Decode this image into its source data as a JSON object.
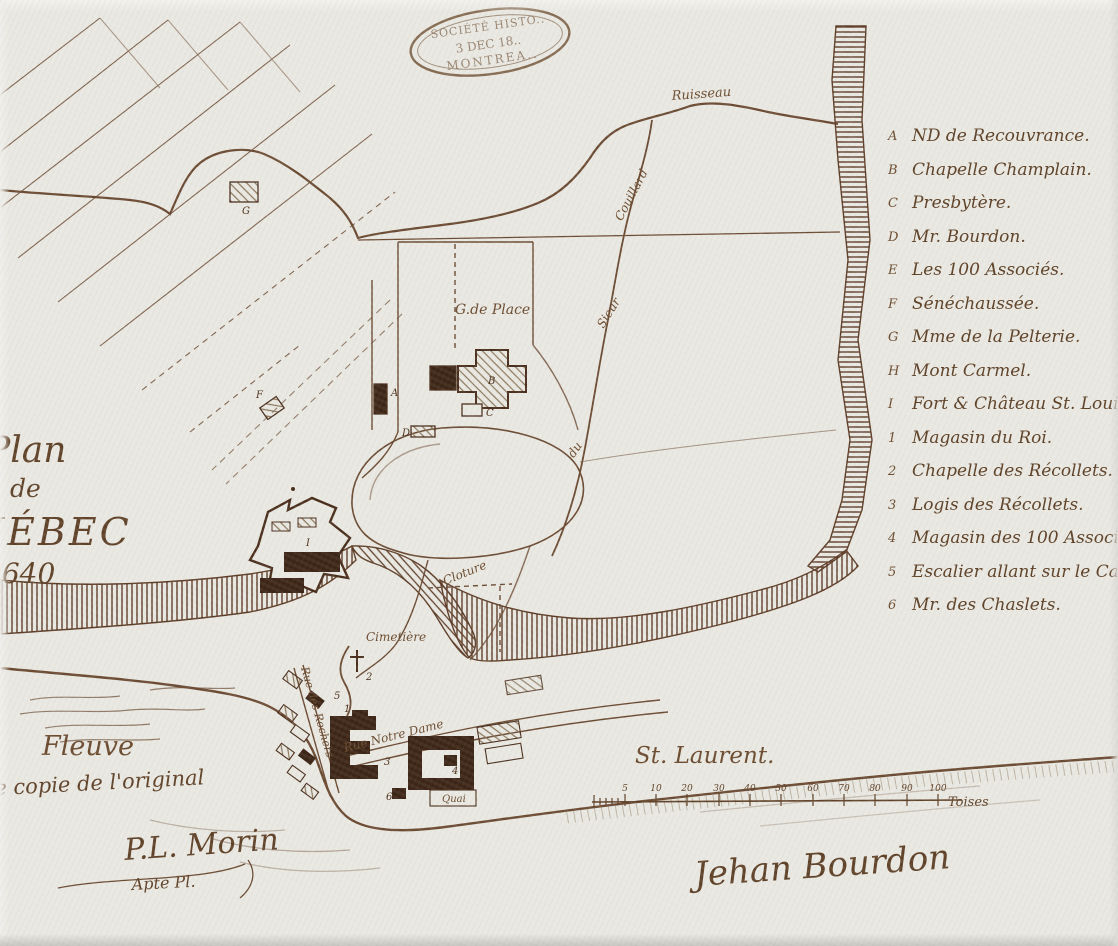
{
  "map": {
    "title_lines": [
      "Plan",
      "de",
      "QUÉBEC",
      "1640"
    ],
    "signature": "Jehan Bourdon",
    "attribution": {
      "line1": "ie copie de l'original",
      "line2": "P.L. Morin",
      "line3": "Apte  Pl."
    },
    "stamp": {
      "line1": "SOCIÉTÉ HISTO..",
      "line2": "3 DEC 18..",
      "line3": "MONTREA.."
    },
    "colors": {
      "paper": "#e9e8e2",
      "ink": "#6b4a32",
      "ink_dark": "#4a2e1c",
      "building_dark": "#3c2516",
      "building_light_hatch": "#8a755a"
    }
  },
  "legend": {
    "items": [
      {
        "key": "A",
        "label": "ND de Recouvrance."
      },
      {
        "key": "B",
        "label": "Chapelle Champlain."
      },
      {
        "key": "C",
        "label": "Presbytère."
      },
      {
        "key": "D",
        "label": "Mr. Bourdon."
      },
      {
        "key": "E",
        "label": "Les 100 Associés."
      },
      {
        "key": "F",
        "label": "Sénéchaussée."
      },
      {
        "key": "G",
        "label": "Mme de la Pelterie."
      },
      {
        "key": "H",
        "label": "Mont Carmel."
      },
      {
        "key": "I",
        "label": "Fort & Château St. Louis."
      },
      {
        "key": "1",
        "label": "Magasin du Roi."
      },
      {
        "key": "2",
        "label": "Chapelle des Récollets."
      },
      {
        "key": "3",
        "label": "Logis des Récollets."
      },
      {
        "key": "4",
        "label": "Magasin des 100 Associés."
      },
      {
        "key": "5",
        "label": "Escalier allant sur le Cap."
      },
      {
        "key": "6",
        "label": "Mr. des Chaslets."
      }
    ]
  },
  "map_labels": {
    "ruisseau": "Ruisseau",
    "couillard": "Couillard",
    "sieur": "Sieur",
    "du": "du",
    "gde_place": "G.de Place",
    "cloture": "Cloture",
    "cimetiere": "Cimetière",
    "rue_notre_dame": "Rue Notre Dame",
    "rue_des_rochers": "Rue des Rochers",
    "quai": "Quai",
    "fleuve": "Fleuve",
    "st_laurent": "St. Laurent."
  },
  "markers": {
    "A": "A",
    "B": "B",
    "C": "C",
    "D": "D",
    "F": "F",
    "G": "G",
    "I": "I",
    "n1": "1",
    "n2": "2",
    "n3": "3",
    "n4": "4",
    "n5": "5",
    "n6": "6"
  },
  "scale": {
    "ticks": [
      "5",
      "10",
      "20",
      "30",
      "40",
      "50",
      "60",
      "70",
      "80",
      "90",
      "100"
    ],
    "unit": "Toises"
  }
}
